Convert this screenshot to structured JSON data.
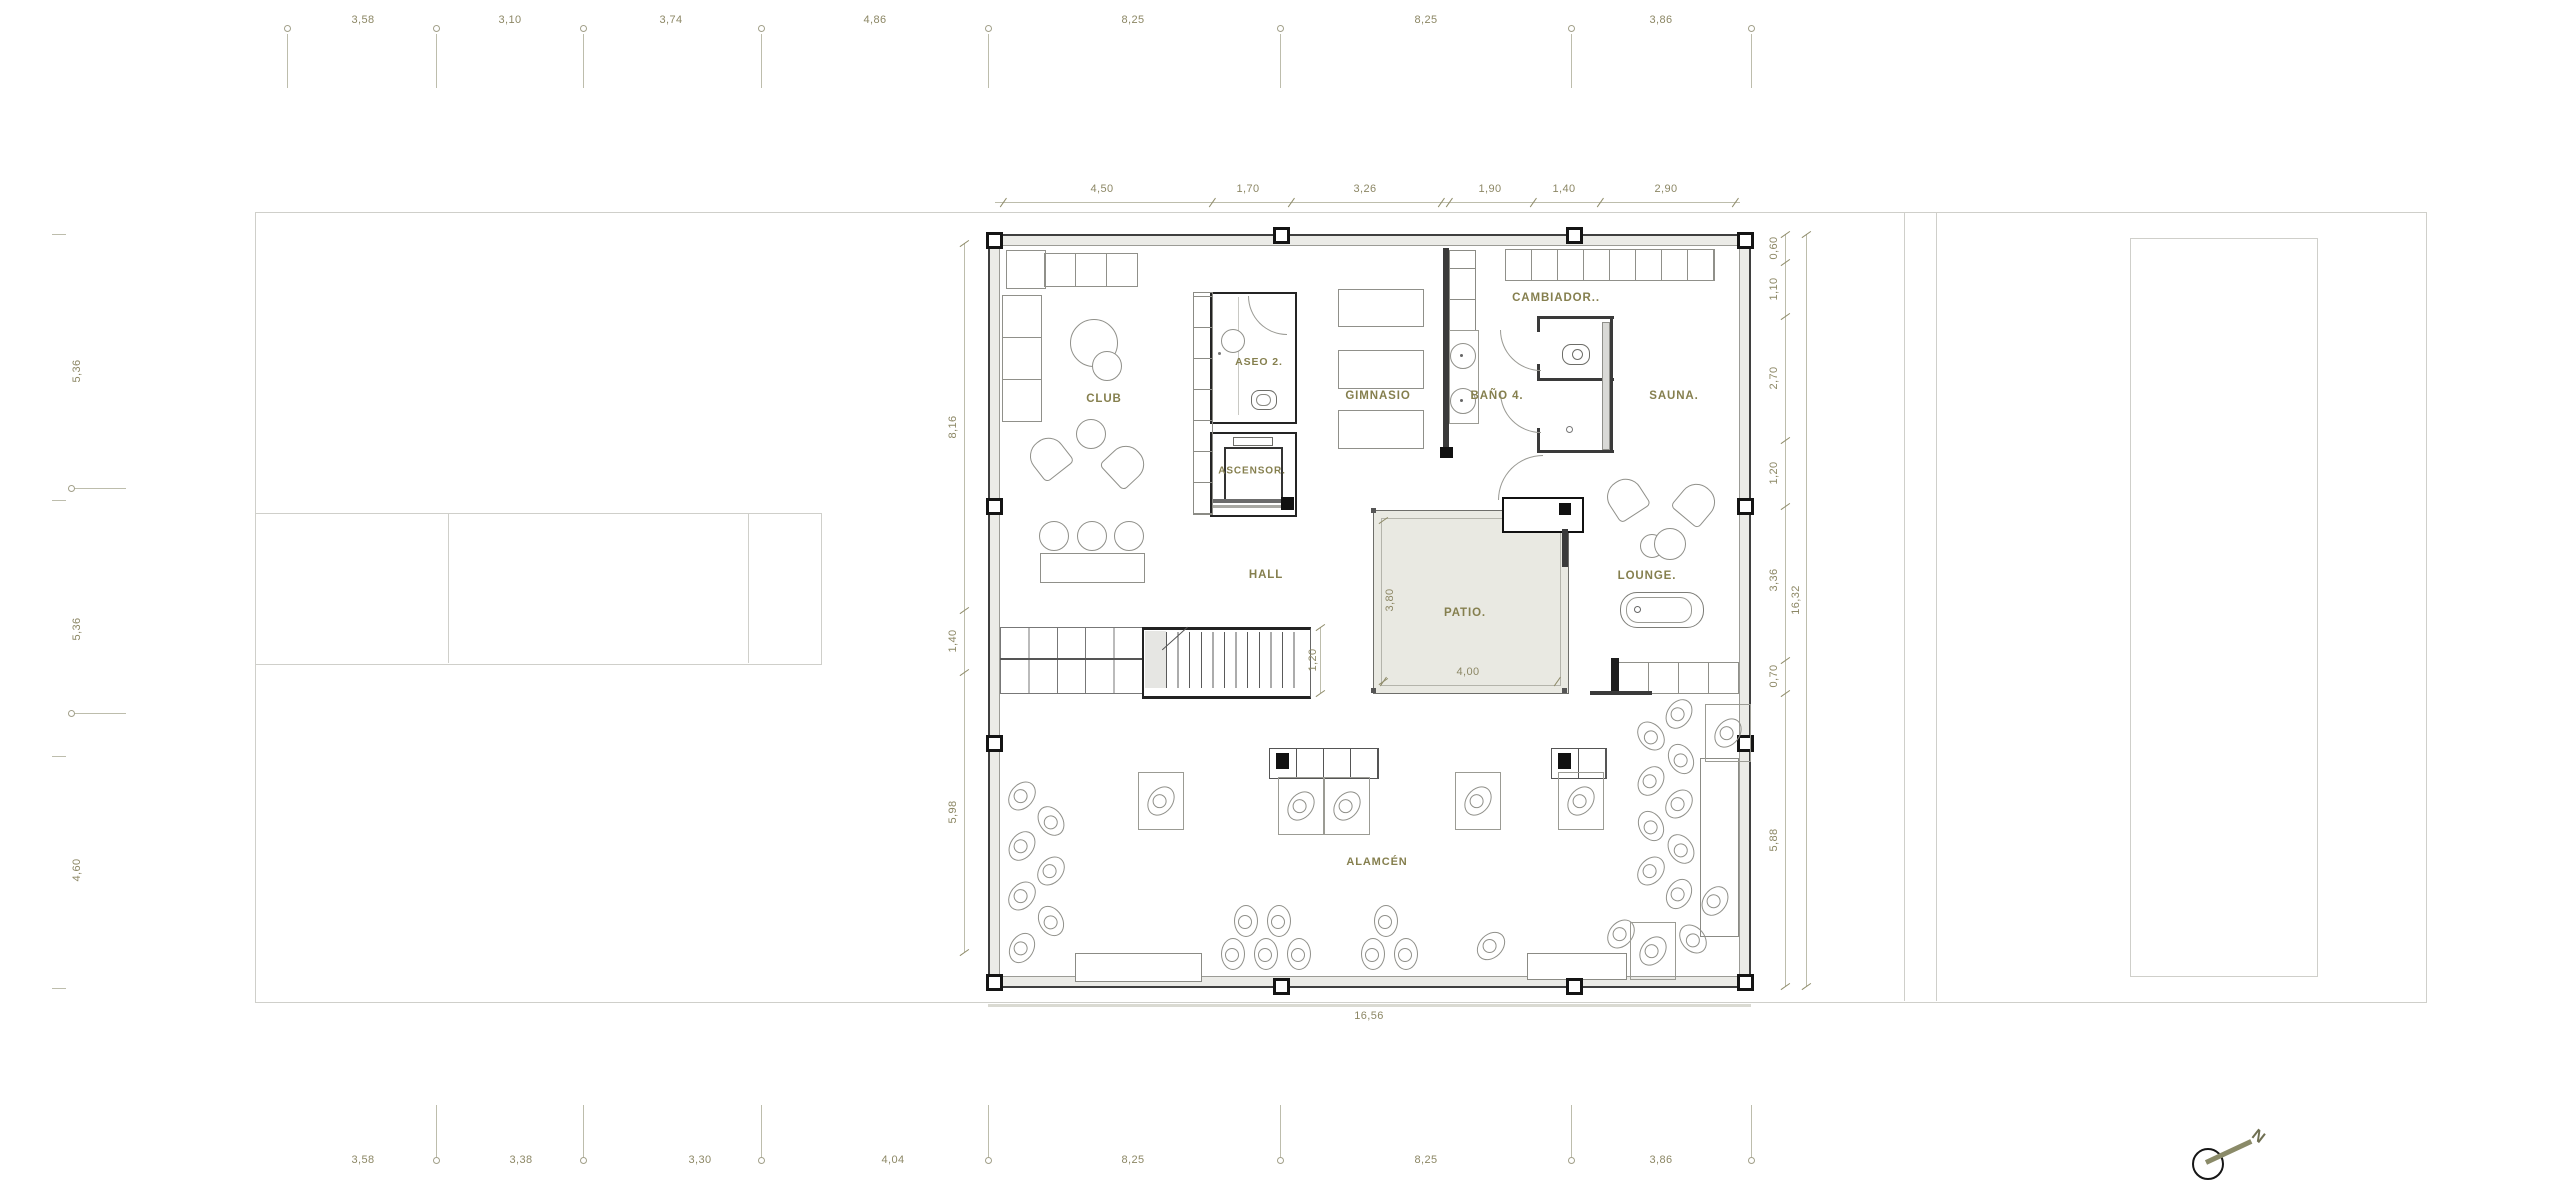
{
  "plan": {
    "rooms": {
      "club": "CLUB",
      "aseo": "ASEO 2.",
      "ascensor": "ASCENSOR.",
      "gimnasio": "GIMNASIO",
      "bano": "BAÑO 4.",
      "cambiador": "CAMBIADOR..",
      "sauna": "SAUNA.",
      "hall": "HALL",
      "patio": "PATIO.",
      "lounge": "LOUNGE.",
      "almacen": "ALAMCÉN"
    },
    "dimensions": {
      "site_top": [
        "3,58",
        "3,10",
        "3,74",
        "4,86",
        "8,25",
        "8,25",
        "3,86"
      ],
      "site_bottom": [
        "3,58",
        "3,38",
        "3,30",
        "4,04",
        "8,25",
        "8,25",
        "3,86"
      ],
      "site_left": [
        "5,36",
        "5,36",
        "4,60"
      ],
      "plan_top": [
        "4,50",
        "1,70",
        "3,26",
        "1,90",
        "1,40",
        "2,90"
      ],
      "plan_left": [
        "8,16",
        "1,40",
        "5,98"
      ],
      "plan_right": [
        "0,60",
        "1,10",
        "2,70",
        "1,20",
        "3,36",
        "0,70",
        "5,88"
      ],
      "plan_right_total": "16,32",
      "plan_bottom_total": "16,56",
      "patio_width": "4,00",
      "patio_height": "3,80",
      "stair_width": "1,20"
    },
    "north_label": "N"
  },
  "colors": {
    "label": "#857f4e",
    "dim_text": "#8c8765",
    "dim_line": "#bdbdac",
    "wall": "#3a3a3a",
    "site_line": "#cfcfca",
    "patio_fill": "#e9e9e2"
  }
}
